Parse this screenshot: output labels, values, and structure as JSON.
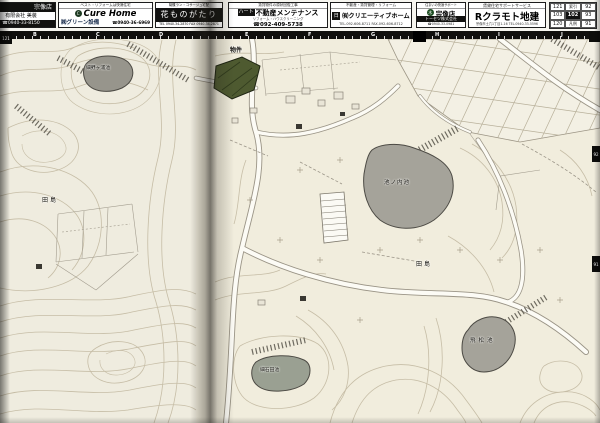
{
  "ads": {
    "ad1": {
      "store": "宗像店",
      "company": "有限会社 美装",
      "phone": "☎0940-33-8150"
    },
    "ad2": {
      "tagline": "ベスト・リフォームは快適住宅",
      "brand": "Cure Home",
      "company": "㈱グリーン設備",
      "phone": "☎0940-36-6969"
    },
    "ad3": {
      "tagline": "胡蝶ラン・コサージュ宅配",
      "brand": "花ものがたり",
      "phone": "TEL 0940-34-2870 FAX 0940-34-2871"
    },
    "ad4": {
      "tagline": "賃貸物件の原状回復工事",
      "brand_prefix": "ハート",
      "brand": "不動産メンテナンス",
      "sub": "リフォーム・ハウスクリーニング",
      "phone": "☎092-409-5738"
    },
    "ad5": {
      "tagline": "不動産・賃貸管理・リフォーム",
      "logo": "日",
      "brand": "㈲クリエーティブホーム",
      "phone": "TEL.092-606-8711 FAX.092-606-8712"
    },
    "ad6": {
      "tagline": "住まいの快適サポート",
      "store": "宗像店",
      "company": "トーセツ株式会社",
      "phone": "☎0940-33-0981"
    },
    "ad7": {
      "tagline": "賃貸住宅サポートサービス",
      "brand": "Rクラモト地建",
      "address_phone": "宗像市土穴1丁目1-16 TEL.0940-33-5596"
    }
  },
  "page_grid": {
    "rows": [
      [
        "121",
        "索引",
        "92"
      ],
      [
        "103",
        "102",
        "93"
      ],
      [
        "120",
        "凡例",
        "91"
      ]
    ]
  },
  "ruler": {
    "left_letters": [
      "B",
      "C",
      "D"
    ],
    "right_letters": [
      "E",
      "F",
      "G",
      "H",
      "I",
      "J"
    ]
  },
  "edge_tabs": {
    "left": "121",
    "right_top": "92",
    "right_bottom": "91"
  },
  "map_labels": {
    "pond_nw": "細野ヶ浦池",
    "district_left": "田島",
    "property": "物件",
    "pond_center": "池ノ内池",
    "district_right": "田島",
    "pond_se": "飛松池",
    "pond_s": "細石田池"
  }
}
